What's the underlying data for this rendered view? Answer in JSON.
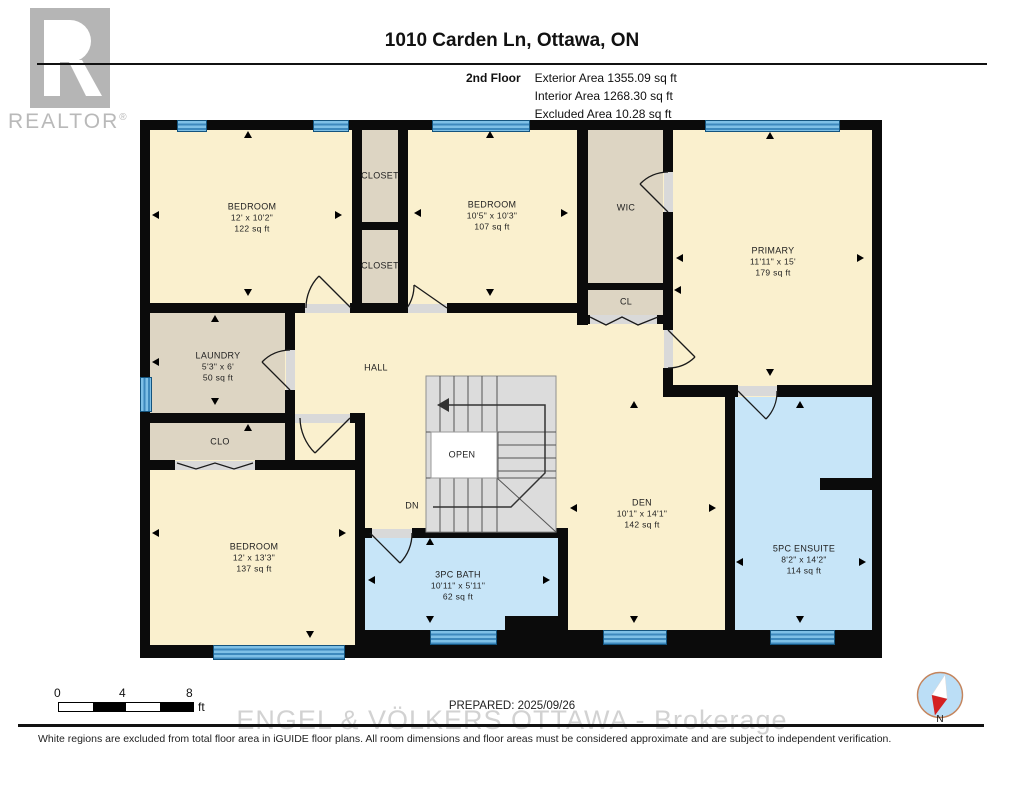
{
  "header": {
    "logo": {
      "brand": "REALTOR",
      "reg": "®"
    },
    "title": "1010 Carden Ln, Ottawa, ON",
    "floor_label": "2nd Floor",
    "areas": [
      {
        "label": "Exterior Area",
        "value": "1355.09 sq ft"
      },
      {
        "label": "Interior Area",
        "value": "1268.30 sq ft"
      },
      {
        "label": "Excluded Area",
        "value": "10.28 sq ft"
      }
    ]
  },
  "rooms": {
    "bedroom1": {
      "name": "BEDROOM",
      "dims": "12' x 10'2\"",
      "area": "122 sq ft"
    },
    "closet1": {
      "name": "CLOSET"
    },
    "closet2": {
      "name": "CLOSET"
    },
    "bedroom2": {
      "name": "BEDROOM",
      "dims": "10'5\" x 10'3\"",
      "area": "107 sq ft"
    },
    "wic": {
      "name": "WIC"
    },
    "cl": {
      "name": "CL"
    },
    "primary": {
      "name": "PRIMARY",
      "dims": "11'11\" x 15'",
      "area": "179 sq ft"
    },
    "laundry": {
      "name": "LAUNDRY",
      "dims": "5'3\" x 6'",
      "area": "50 sq ft"
    },
    "hall": {
      "name": "HALL"
    },
    "clo": {
      "name": "CLO"
    },
    "bedroom3": {
      "name": "BEDROOM",
      "dims": "12' x 13'3\"",
      "area": "137 sq ft"
    },
    "bath": {
      "name": "3PC BATH",
      "dims": "10'11\" x 5'11\"",
      "area": "62 sq ft"
    },
    "den": {
      "name": "DEN",
      "dims": "10'1\" x 14'1\"",
      "area": "142 sq ft"
    },
    "ensuite": {
      "name": "5PC ENSUITE",
      "dims": "8'2\" x 14'2\"",
      "area": "114 sq ft"
    }
  },
  "stairs": {
    "open": "OPEN",
    "dn": "DN"
  },
  "scale_bar": {
    "ticks": [
      "0",
      "4",
      "8"
    ],
    "unit": "ft"
  },
  "footer": {
    "prepared": "PREPARED: 2025/09/26",
    "watermark": "ENGEL & VÖLKERS OTTAWA - Brokerage",
    "disclaimer": "White regions are excluded from total floor area in iGUIDE floor plans. All room dimensions and floor areas must be considered approximate and are subject to independent verification.",
    "compass": "N"
  },
  "colors": {
    "room": "#FAF0CE",
    "closet": "#DDD5C3",
    "wet": "#C7E5F8",
    "window": "#5AAAD9",
    "wall": "#0B0B0B",
    "stairs": "#DCDCDC"
  }
}
